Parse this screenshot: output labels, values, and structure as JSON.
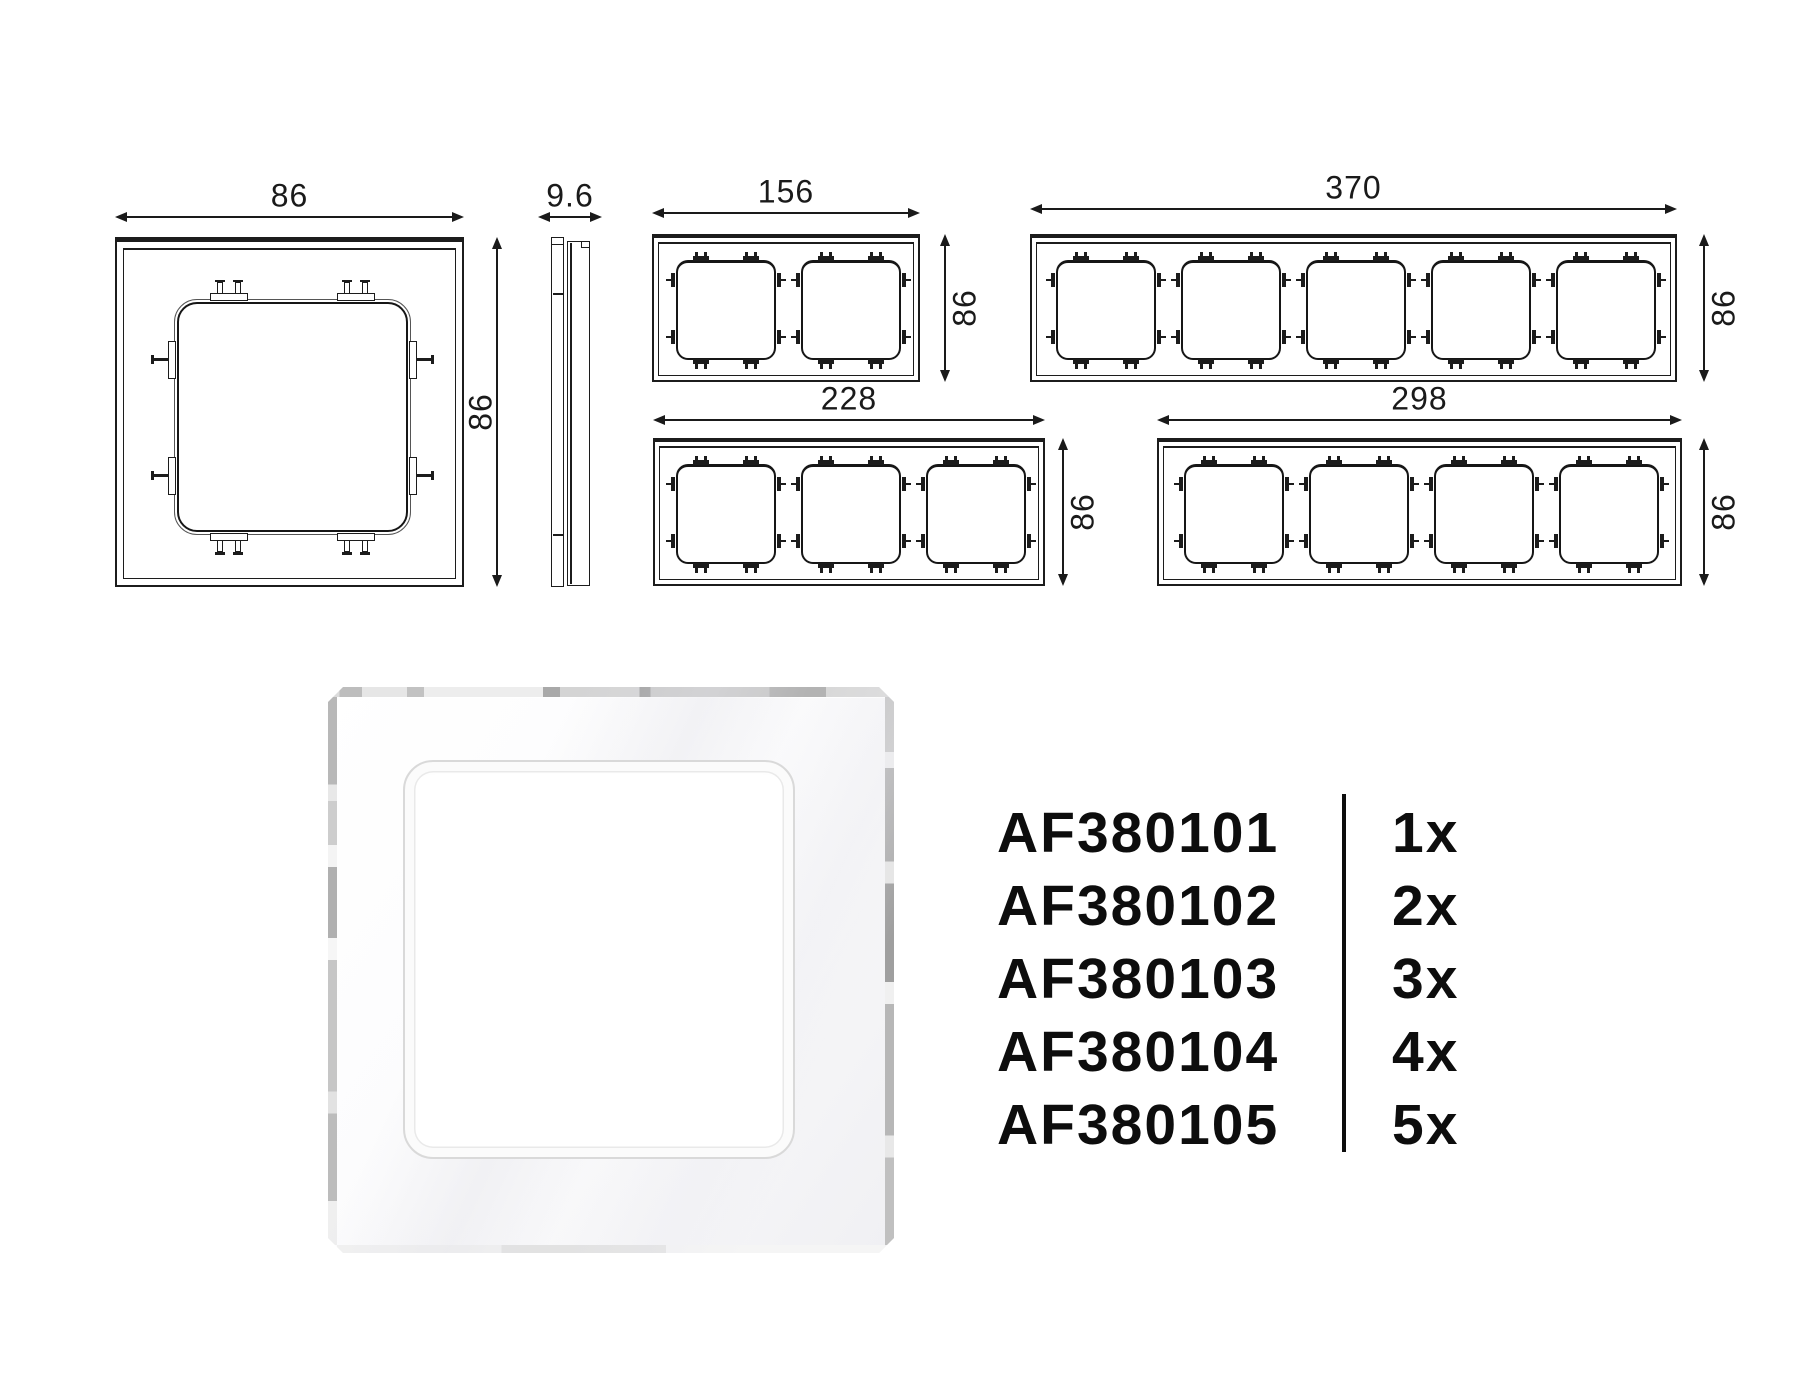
{
  "page": {
    "background": "#ffffff",
    "line_color": "#1c1c1c",
    "dim_text_color": "#1a1a1a",
    "text_color": "#0d0d0d"
  },
  "drawings": {
    "views": [
      {
        "id": "front-1gang",
        "type": "frame",
        "gangs": 1,
        "top_dim": "86",
        "side_dim": "86"
      },
      {
        "id": "side-profile",
        "type": "side",
        "gangs": 0,
        "top_dim": "9.6",
        "side_dim": null
      },
      {
        "id": "front-2gang",
        "type": "frame",
        "gangs": 2,
        "top_dim": "156",
        "side_dim": "86"
      },
      {
        "id": "front-5gang",
        "type": "frame",
        "gangs": 5,
        "top_dim": "370",
        "side_dim": "86"
      },
      {
        "id": "front-3gang",
        "type": "frame",
        "gangs": 3,
        "top_dim": "228",
        "side_dim": "86"
      },
      {
        "id": "front-4gang",
        "type": "frame",
        "gangs": 4,
        "top_dim": "298",
        "side_dim": "86"
      }
    ]
  },
  "photo": {
    "subject": "white-glass-single-frame",
    "frame_color": "#f7f7f8",
    "edge_color": "#b5b5b5",
    "window_rim_color": "#d9d9d9"
  },
  "product_list": {
    "items": [
      {
        "code": "AF380101",
        "qty": "1x"
      },
      {
        "code": "AF380102",
        "qty": "2x"
      },
      {
        "code": "AF380103",
        "qty": "3x"
      },
      {
        "code": "AF380104",
        "qty": "4x"
      },
      {
        "code": "AF380105",
        "qty": "5x"
      }
    ]
  }
}
